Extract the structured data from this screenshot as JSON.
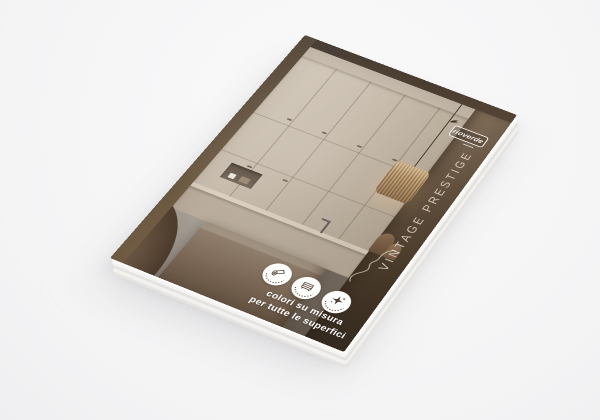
{
  "scene": {
    "description": "3D mockup of a stacked interior-design paint catalog on a white surface",
    "background_color": "#f6f6f7"
  },
  "brochure": {
    "logo": {
      "text": "rioverde",
      "icon": "bird-icon",
      "box_color": "#ffffff"
    },
    "title_vertical": "VINTAGE PRESTIGE",
    "tagline": {
      "line1": "colori su misura",
      "line2": "per tutte le superfici"
    },
    "badges": [
      {
        "icon_name": "rolled-surface-icon"
      },
      {
        "icon_name": "furniture-icon"
      },
      {
        "icon_name": "sparkles-icon"
      }
    ],
    "colors": {
      "dark_panel": "#5e4d3b",
      "wood_band": "#4f3f30",
      "cabinets": "#c9bdae",
      "island": "#8f7c6a",
      "floor": "#9b948c",
      "lamp": "#caa878",
      "title_text": "#ece2d5",
      "tagline_text": "#ffffff",
      "badge_icon": "#4a392c"
    }
  }
}
